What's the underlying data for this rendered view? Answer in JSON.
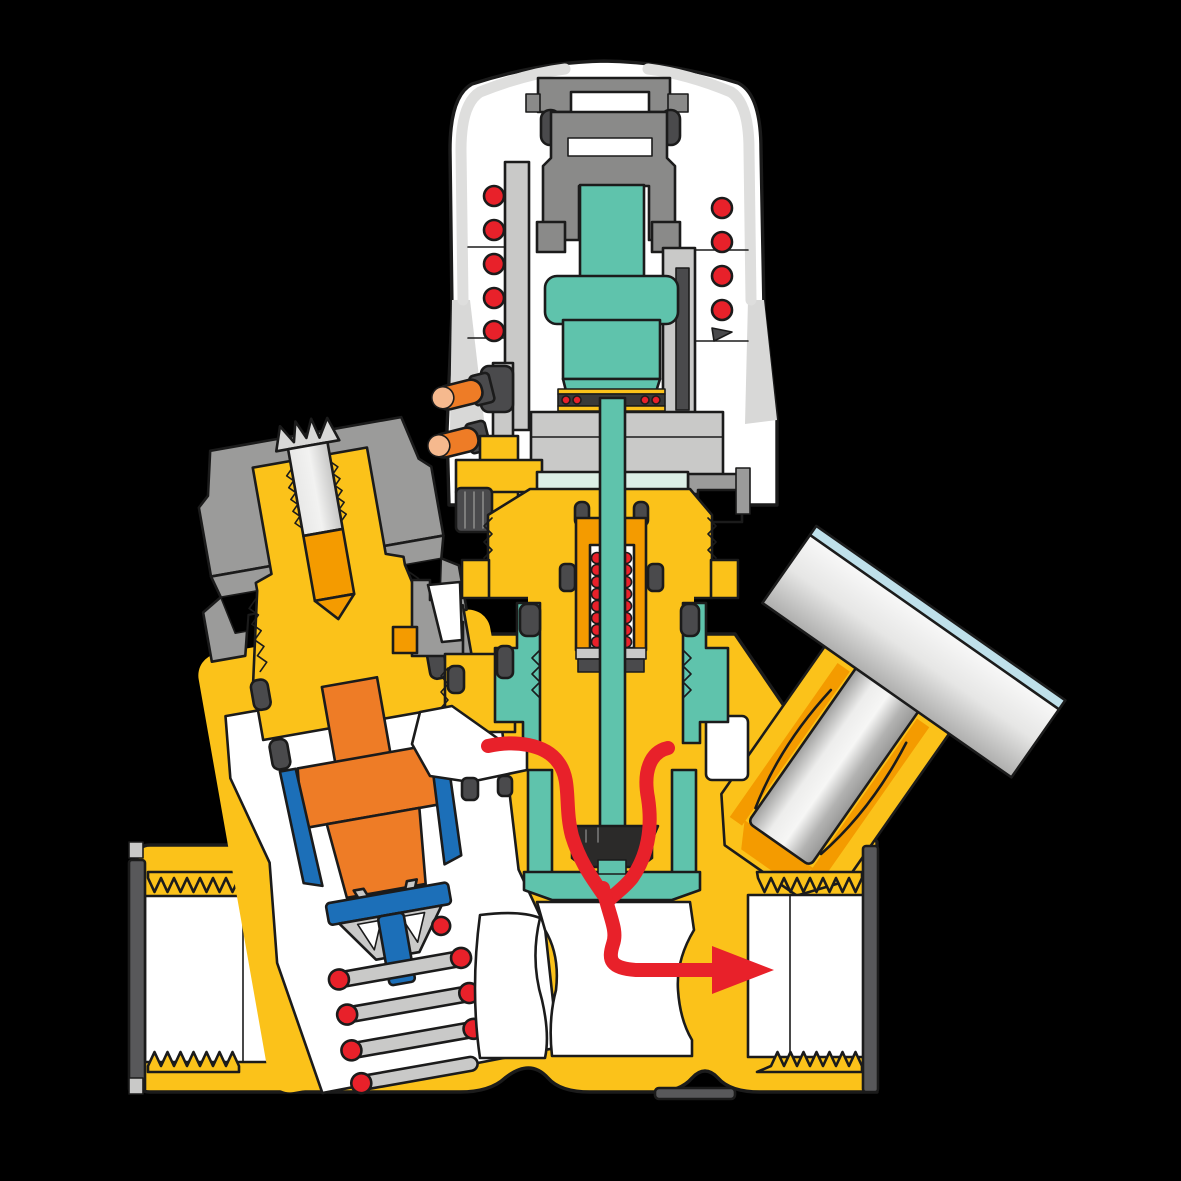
{
  "diagram": {
    "title": "thermostatic-mixing-valve-cutaway",
    "type": "technical-cross-section",
    "flow_arrow": {
      "color": "#e8212a",
      "direction": "right",
      "meaning": "mixed-water-outlet-flow"
    }
  },
  "palette": {
    "bg": "#000000",
    "line": "#1b1b1b",
    "brass": "#fbc21a",
    "brassDeep": "#f49b00",
    "orange": "#ee7c26",
    "peach": "#f6b98e",
    "teal": "#5fc3ac",
    "tealPale": "#dcefe6",
    "red": "#e8212a",
    "blue": "#1c6fb8",
    "blueLight": "#bfe0ea",
    "white": "#ffffff",
    "grayLight": "#c9c9c8",
    "grayMid": "#9b9b9a",
    "grayDdeep": "#7c7c7b",
    "grayCarrier": "#8a8a89",
    "grayDark": "#58585a",
    "lugDark": "#4a4a4c",
    "nearBlack": "#2b2a29",
    "shellShade": "#d8d8d7"
  },
  "components": [
    {
      "id": "thermostatic-head",
      "label": "thermostatic head with overtravel spring"
    },
    {
      "id": "head-spring-coils",
      "label": "spring coil sections (red dots)"
    },
    {
      "id": "wax-element",
      "label": "teal thermostatic wax element and stem"
    },
    {
      "id": "bonnet",
      "label": "brass bonnet with O-rings and return spring"
    },
    {
      "id": "cage",
      "label": "teal shutter cage and seat"
    },
    {
      "id": "shutter-disc",
      "label": "black shutter disc"
    },
    {
      "id": "balancing-cartridge",
      "label": "left pressure-balancing cartridge with piston, cup seal and spring"
    },
    {
      "id": "sensor-boss",
      "label": "angled temperature sensor pocket with dial body"
    },
    {
      "id": "inlet-port",
      "label": "left threaded inlet port"
    },
    {
      "id": "outlet-port",
      "label": "right threaded outlet port"
    },
    {
      "id": "flow-arrow",
      "label": "red mixed-flow path arrow"
    }
  ]
}
